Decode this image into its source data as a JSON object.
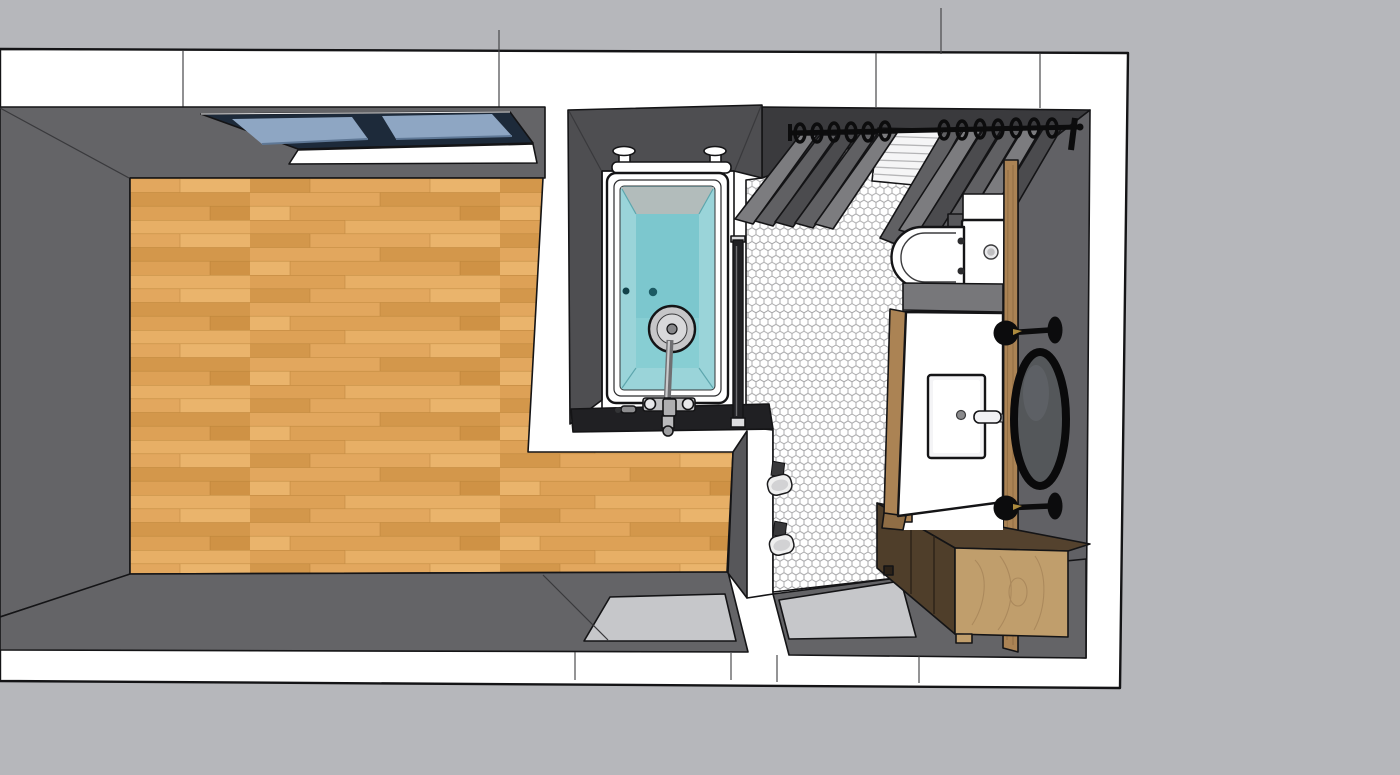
{
  "scene": {
    "kind": "3d-model-top-view",
    "description": "overhead 3d floor plan: bedroom with wood floor and skylight on the left, bathroom with hex tile floor, bathtub, shower curtain, toilet, vanity, round mirror and wood cabinet on the right",
    "rooms": [
      {
        "name": "bedroom",
        "floor": "wood-planks"
      },
      {
        "name": "bathroom",
        "floor": "white-hex-tile"
      }
    ],
    "objects": [
      "skylight",
      "wood-floor",
      "door-threshold-left",
      "door-threshold-right",
      "bathtub",
      "tub-water",
      "tub-filler",
      "towel-bar",
      "glass-screen",
      "shower-curtain-rod",
      "shower-curtain-left",
      "shower-curtain-right",
      "towel-radiator",
      "toilet",
      "toilet-tank",
      "flush-button",
      "vanity-counter",
      "sink",
      "sink-faucet",
      "round-mirror",
      "wall-hook-upper",
      "wall-hook-lower",
      "toilet-paper-holder-upper",
      "toilet-paper-holder-lower",
      "wood-cabinet",
      "wood-wall-strip",
      "hex-tile-floor"
    ]
  },
  "palette": {
    "canvas_bg": "#b6b7bb",
    "plan_white": "#ffffff",
    "outline": "#141416",
    "wall_dark": "#646467",
    "wall_seam": "#39393c",
    "nook_wall": "#4e4e51",
    "nook_shadow": "#202023",
    "inner_face": "#57575a",
    "curtain_band": "#3a3a3d",
    "right_wall": "#616165",
    "threshold": "#c6c7ca",
    "jamb_line": "#3c3c3e",
    "skylight_frame": "#1d2a3a",
    "skylight_glass": "#8ea6c3",
    "skylight_glass_edge": "#5f7896",
    "wood1": "#dda156",
    "wood2": "#e7af66",
    "wood3": "#d3974b",
    "wood4": "#e2a75e",
    "wood5": "#eab46c",
    "wood6": "#cf9245",
    "wood_gap": "#a9742c",
    "hex_line": "#a6a6a8",
    "water_wall": "#9ad4d9",
    "water_deep": "#7cc7ce",
    "water_low": "#8fd2d7",
    "water_gray": "#b2bcbb",
    "water_edge": "#5da6ad",
    "chrome_light": "#e8e8ea",
    "chrome_mid": "#b9b9bb",
    "chrome_dark": "#8e8e90",
    "porcelain": "#ffffff",
    "porcelain_shade": "#d8d8da",
    "toilet_backdrop": "#58585b",
    "toilet_shadow": "#77777a",
    "curtain_1": "#7c7c7f",
    "curtain_2": "#606063",
    "curtain_3": "#4b4b4e",
    "radiator_line": "#b4b4b6",
    "fixture_black": "#0c0c0d",
    "gold_pin": "#ad8b3e",
    "mirror_glass": "#54575a",
    "mirror_glass_hi": "#5e6266",
    "glass_screen": "#212124",
    "wood_trim": "#ab8354",
    "wood_grain": "#8d6a3f",
    "vanity_base": "#8f6d45",
    "cabinet_top": "#54422e",
    "cabinet_front": "#4f3e2a",
    "cabinet_seam": "#2c2218",
    "cabinet_end": "#c09e6c",
    "cabinet_grain": "#a8865a",
    "sink_drain": "#8a8a8c"
  }
}
